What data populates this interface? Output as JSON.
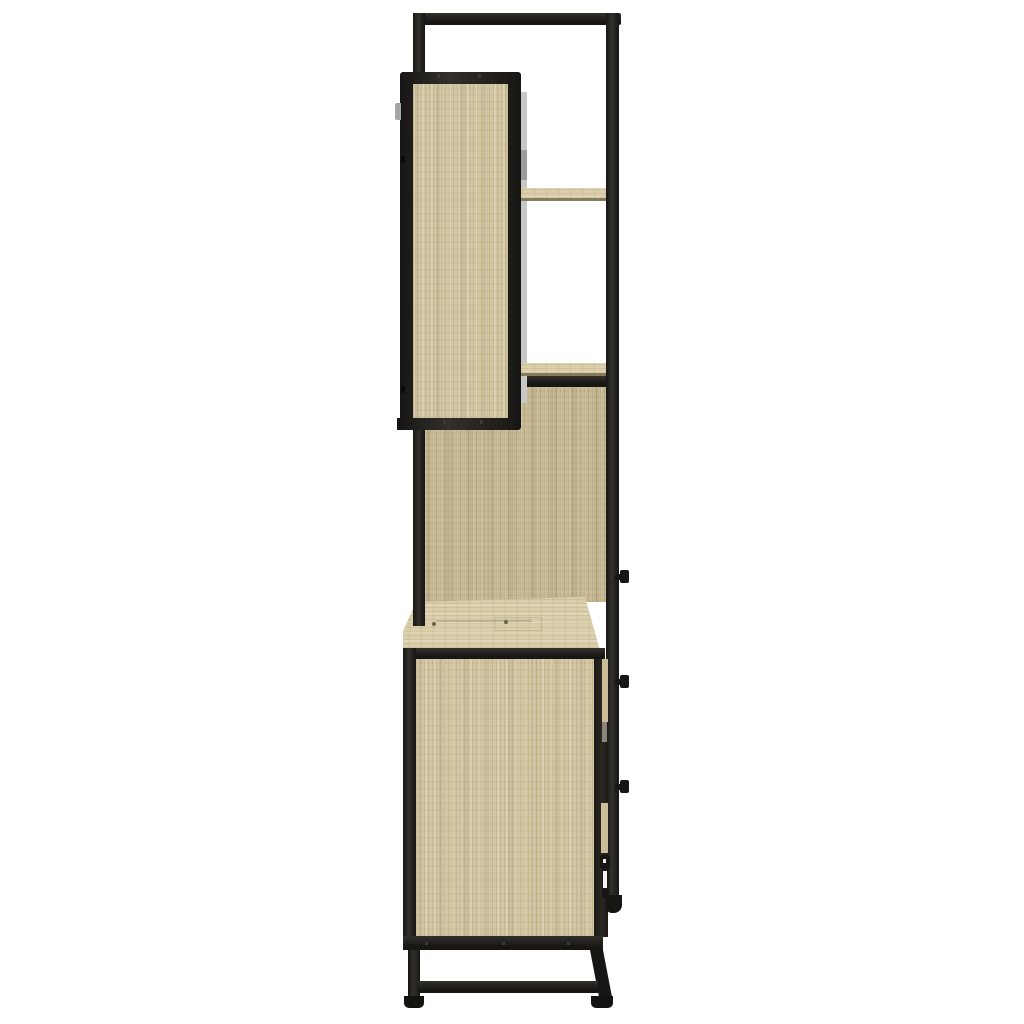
{
  "scene": {
    "type": "product-photo",
    "description": "Side view product photograph of a 3-piece bathroom furniture set on a plain white background: black metal wall frame with a wall-mounted sonoma-oak mirror cabinet and two open oak shelves, an enclosed oak tall-cabinet section, and a washbasin floor cabinet with oak panels, black metal frame, angled rear leg, stretcher bar and black feet; small black knobs, hinges and a door handle protrude on the right side.",
    "background": "#ffffff",
    "visible_text": ""
  },
  "palette": {
    "background": "#ffffff",
    "metal_lo": "#171614",
    "metal_hi": "#32302b",
    "wood_light": "#d3c6a2",
    "wood_mid": "#c8bb95",
    "wood_pale": "#dbcfab",
    "wood_edge": "#857b5b",
    "hole_brown": "#6b6348",
    "mirror_gray": "#c7c7c8",
    "mirror_shadow": "#9d9da0",
    "edge_dark": "#2b2722",
    "tan_sliver": "#cbbd97",
    "gray_bit": "#8a857c",
    "foot_black": "#141312"
  },
  "parts": {
    "wall_frame": "tall black metal wall frame",
    "mirror_cabinet": "wall-mounted bathroom mirror cabinet, oak side panel, mirror edge visible",
    "upper_shelf": "open oak shelf",
    "lower_shelf": "open oak shelf over enclosed section",
    "back_panel": "oak panel of enclosed tall-cabinet section",
    "base_cabinet": "washbasin floor cabinet with oak top and side panel",
    "hardware": "black door knobs, hinge pins and handle bracket on right side",
    "legs": "black metal legs with stretcher bar and feet"
  }
}
